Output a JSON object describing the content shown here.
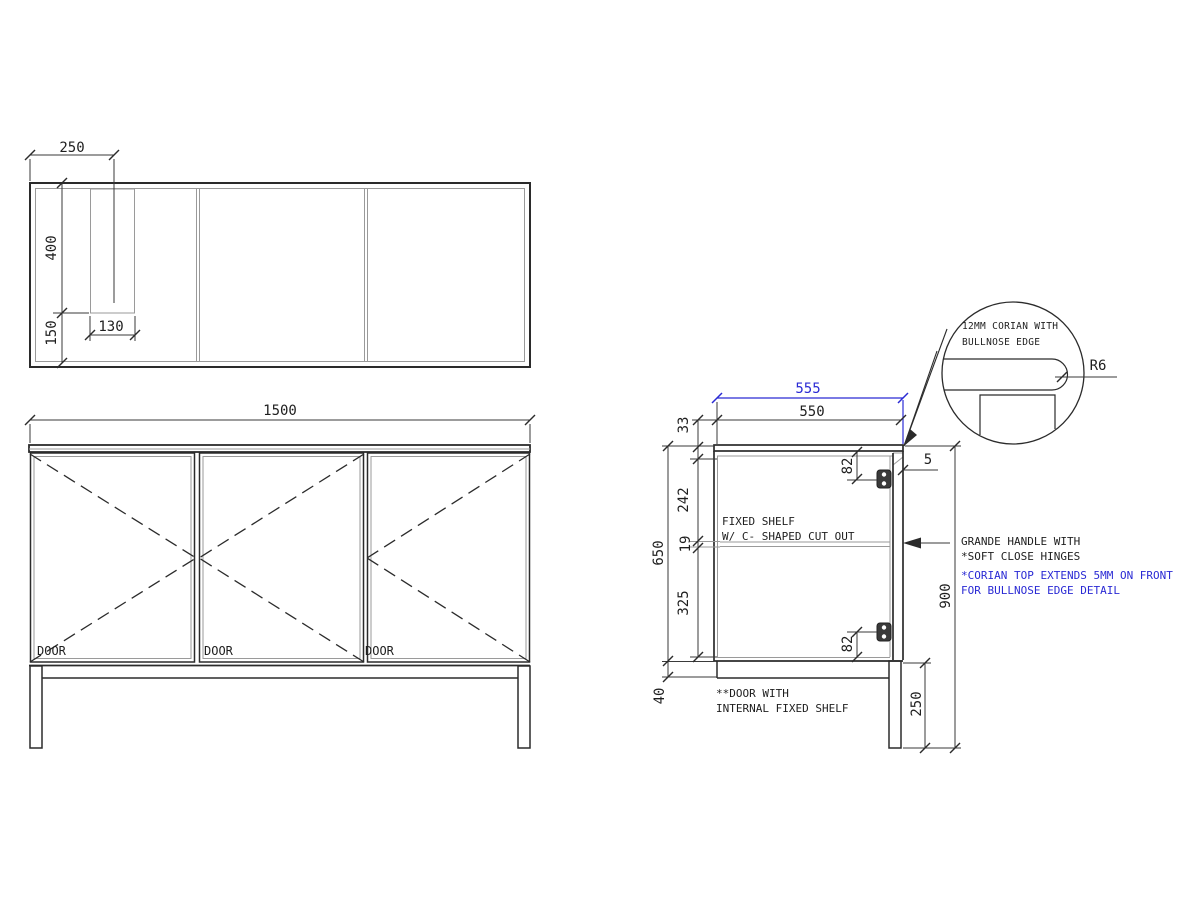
{
  "plan": {
    "dim_250": "250",
    "dim_400": "400",
    "dim_150": "150",
    "dim_130": "130"
  },
  "elevation": {
    "dim_width": "1500",
    "doors": [
      "DOOR",
      "DOOR",
      "DOOR"
    ]
  },
  "section": {
    "dim_555": "555",
    "dim_550": "550",
    "dim_33": "33",
    "dim_242": "242",
    "dim_19": "19",
    "dim_325": "325",
    "dim_650": "650",
    "dim_40": "40",
    "dim_82_top": "82",
    "dim_82_bottom": "82",
    "dim_5": "5",
    "dim_900": "900",
    "dim_250": "250",
    "note_fixed_shelf_line1": "FIXED SHELF",
    "note_fixed_shelf_line2": "W/ C- SHAPED CUT OUT",
    "note_door_line1": "**DOOR WITH",
    "note_door_line2": "INTERNAL FIXED SHELF",
    "note_handle_line1": "GRANDE HANDLE WITH",
    "note_handle_line2": "*SOFT CLOSE HINGES",
    "note_corian_line1": "*CORIAN TOP EXTENDS 5MM ON FRONT",
    "note_corian_line2": "FOR BULLNOSE EDGE DETAIL"
  },
  "detail": {
    "note_line1": "12MM CORIAN WITH",
    "note_line2": "BULLNOSE EDGE",
    "radius_label": "R6"
  },
  "colors": {
    "accent_blue": "#2a2ad4",
    "line_dark": "#2b2b2b"
  }
}
